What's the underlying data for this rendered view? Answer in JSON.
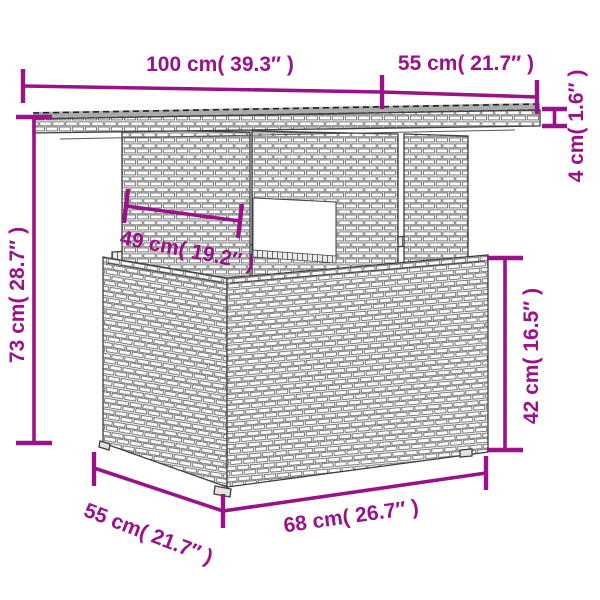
{
  "figure": {
    "type": "product-dimension-diagram",
    "subject": "rattan garden table line drawing",
    "background": "#ffffff",
    "accent_color": "#9a1288",
    "furniture_fill": "#f5f5f5",
    "furniture_outline": "#3f3f3f"
  },
  "dims": {
    "top_width": {
      "label": "100 cm( 39.3″ )"
    },
    "top_depth": {
      "label": "55 cm( 21.7″ )"
    },
    "top_thickness": {
      "label": "4 cm( 1.6″ )"
    },
    "total_height": {
      "label": "73 cm( 28.7″ )"
    },
    "leg_width": {
      "label": "49 cm( 19.2″ )"
    },
    "base_height": {
      "label": "42 cm( 16.5″ )"
    },
    "base_depth": {
      "label": "55 cm( 21.7″ )"
    },
    "base_width": {
      "label": "68 cm( 26.7″ )"
    }
  }
}
